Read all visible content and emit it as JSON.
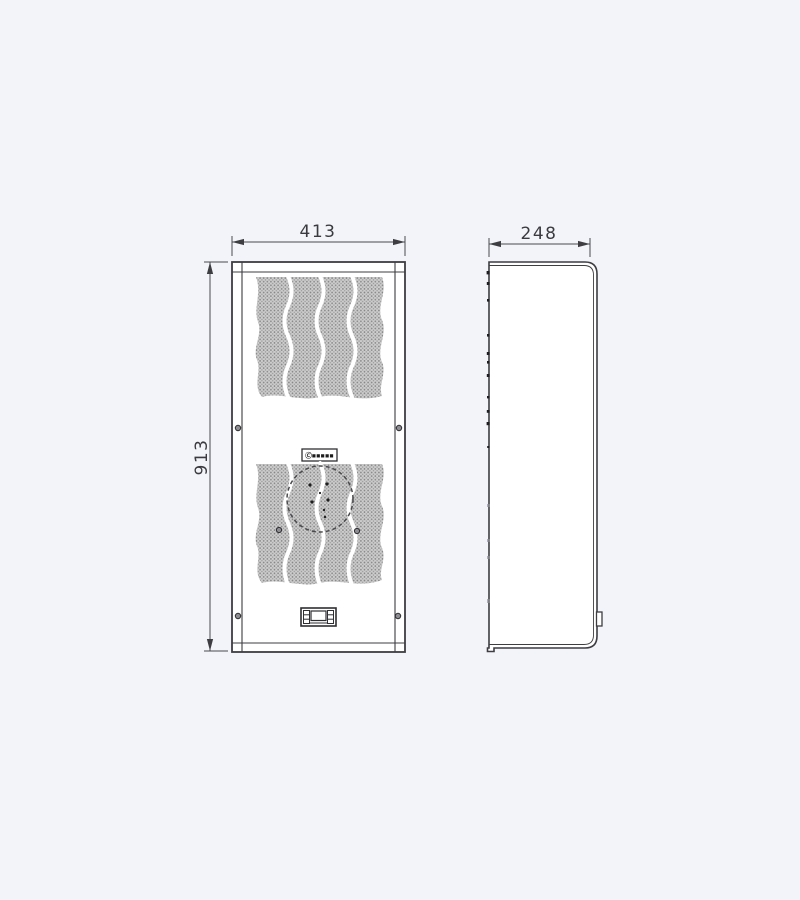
{
  "drawing": {
    "title": "enclosure-cooling-unit-dimension-drawing",
    "views": {
      "front": {
        "name": "front-view",
        "width_dim": "413",
        "height_dim": "913"
      },
      "side": {
        "name": "side-view",
        "depth_dim": "248"
      }
    },
    "logo": {
      "text": "Ⓒ▪▪▪▪▪"
    },
    "colors": {
      "background": "#f2f4f9",
      "panel_fill": "#ffffff",
      "line": "#3d3d42",
      "dimension_line": "#4a4a50",
      "mesh_base": "#cfcfcf",
      "mesh_dot": "#8a8a8a"
    }
  }
}
